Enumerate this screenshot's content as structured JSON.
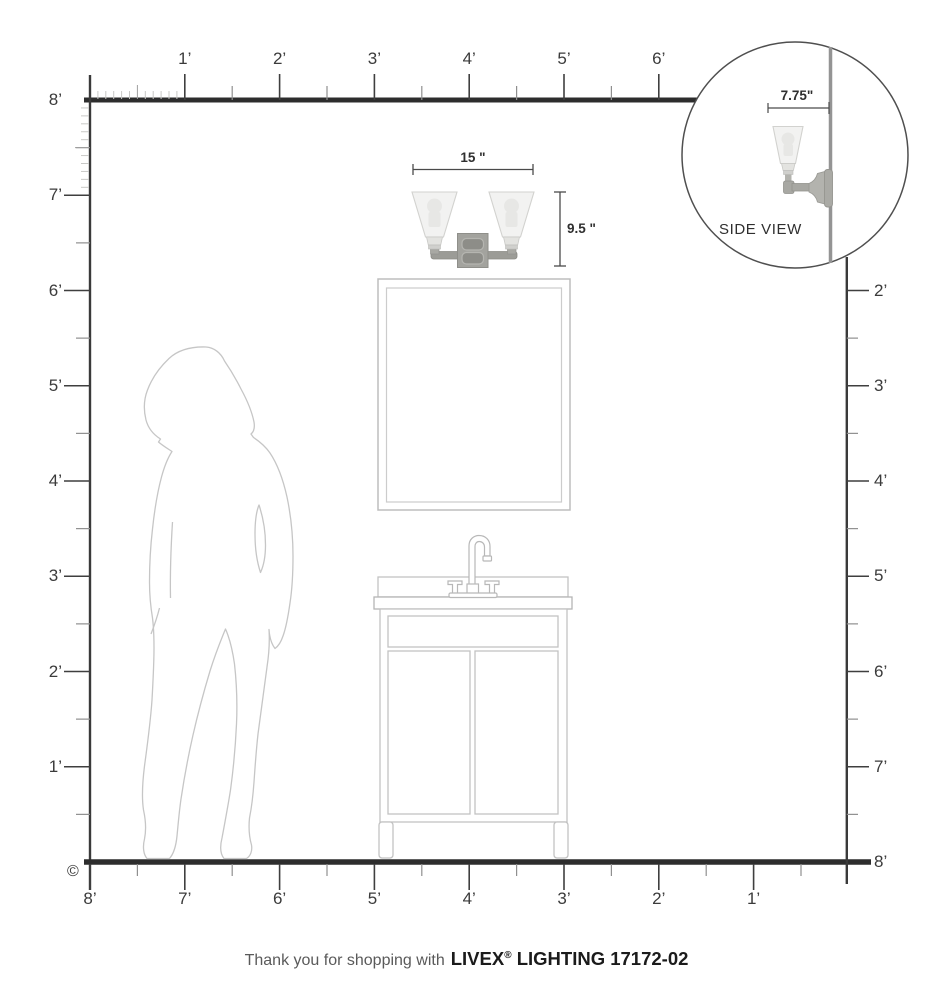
{
  "page": {
    "copyright": "©"
  },
  "rulers": {
    "top": [
      "1’",
      "2’",
      "3’",
      "4’",
      "5’",
      "6’"
    ],
    "left": [
      "8’",
      "7’",
      "6’",
      "5’",
      "4’",
      "3’",
      "2’",
      "1’"
    ],
    "bottom": [
      "8’",
      "7’",
      "6’",
      "5’",
      "4’",
      "3’",
      "2’",
      "1’"
    ],
    "right": [
      "2’",
      "3’",
      "4’",
      "5’",
      "6’",
      "7’"
    ],
    "right_floor": "8’"
  },
  "fixture": {
    "name": "two-light-vanity-sconce",
    "width": "15 \"",
    "height": "9.5 \""
  },
  "side_view": {
    "label": "SIDE VIEW",
    "depth": "7.75\""
  },
  "footer": {
    "prefix": "Thank you for shopping with",
    "brand": "LIVEX",
    "reg": "®",
    "suffix": " LIGHTING 17172-02"
  },
  "colors": {
    "wall_line": "#2d2d2d",
    "ruler_line": "#3a3a3a",
    "tick_major": "#3f3f3f",
    "tick_half": "#8f8f8f",
    "tick_inch": "#c8c8c6",
    "outline_light": "#c6c6c6",
    "dimension_line": "#4a4a4a",
    "metal": "#9c9c97",
    "metal_dark": "#8a8a85",
    "glass_shade": "#ededeb"
  }
}
